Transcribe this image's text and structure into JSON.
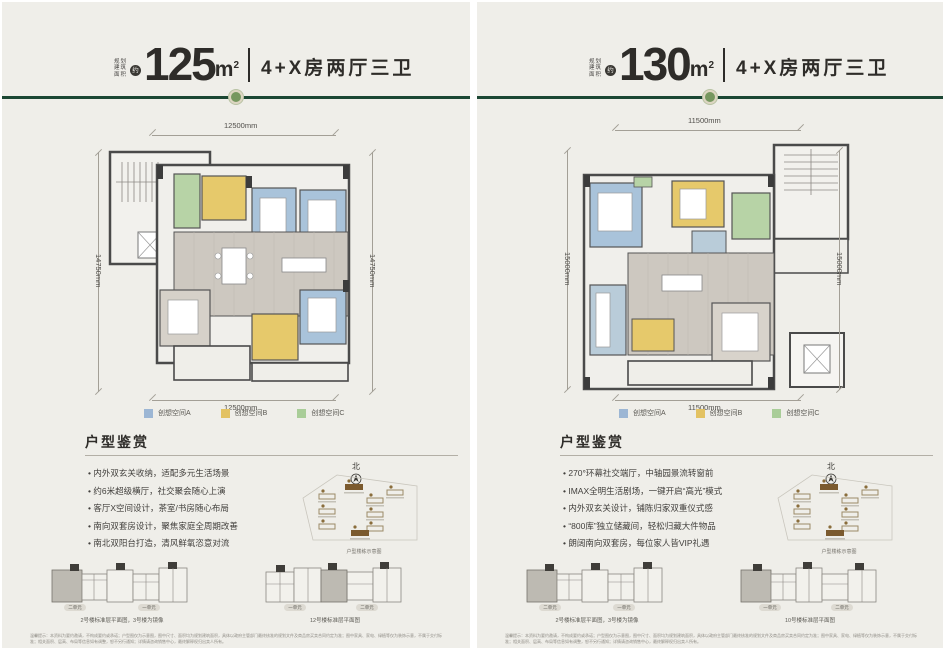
{
  "colors": {
    "divider_green": "#1b4733",
    "ornament_green": "#76975f",
    "legend_a_blue": "#9cb6d4",
    "legend_b_yellow": "#e3c262",
    "legend_c_green": "#a9cd98",
    "room_blue": "#a9c3da",
    "room_yellow": "#e6c96b",
    "room_green": "#b7d3a6",
    "floor_gray": "#cdc8c0",
    "panel_bg": "#efeee9"
  },
  "panels": [
    {
      "header": {
        "area_label_lines": [
          "规划",
          "建筑",
          "面积"
        ],
        "approx": "约",
        "area_value": "125",
        "area_unit": "m",
        "area_exp": "2",
        "type_text": "4+X房两厅三卫"
      },
      "plan_dims": {
        "top": "12500mm",
        "bottom": "12500mm",
        "left": "14750mm",
        "right": "14750mm"
      },
      "legend": [
        {
          "label": "创想空间A",
          "color": "#9cb6d4"
        },
        {
          "label": "创想空间B",
          "color": "#e3c262"
        },
        {
          "label": "创想空间C",
          "color": "#a9cd98"
        }
      ],
      "section_title": "户型鉴赏",
      "bullets": [
        "内外双玄关收纳，适配多元生活场景",
        "约6米超级横厅，社交聚会随心上演",
        "客厅X空间设计，茶室/书房随心布局",
        "南向双套房设计，聚焦家庭全周期改善",
        "南北双阳台打造，清风鲜氧恣意对流"
      ],
      "north_label": "北",
      "siteplan_caption": "户型楼栋示意图",
      "footer_diagrams": [
        {
          "caption": "2号楼标准层平面图，3号楼为镜像",
          "unit_left": "二单元",
          "unit_right": "一单元"
        },
        {
          "caption": "12号楼标准层平面图",
          "unit_left": "一单元",
          "unit_right": "二单元"
        }
      ],
      "disclaimer": "温馨提示：本资料为要约邀请，不构成要约或承诺；户型图仅为示意图，图中尺寸、面积均为规划建筑面积，具体以政府主管部门最终核准的规划文件及商品房买卖合同约定为准；图中家具、家电、绿植等仅为装饰示意，不属于交付标准；相关面积、层高、布局等信息如有调整，恕不另行通知；详情请咨询销售中心，最终解释权归出卖人所有。"
    },
    {
      "header": {
        "area_label_lines": [
          "规划",
          "建筑",
          "面积"
        ],
        "approx": "约",
        "area_value": "130",
        "area_unit": "m",
        "area_exp": "2",
        "type_text": "4+X房两厅三卫"
      },
      "plan_dims": {
        "top": "11500mm",
        "bottom": "11500mm",
        "left": "15000mm",
        "right": "15000mm"
      },
      "legend": [
        {
          "label": "创想空间A",
          "color": "#9cb6d4"
        },
        {
          "label": "创想空间B",
          "color": "#e3c262"
        },
        {
          "label": "创想空间C",
          "color": "#a9cd98"
        }
      ],
      "section_title": "户型鉴赏",
      "bullets": [
        "270°环幕社交端厅，中轴园景流转窗前",
        "IMAX全明生活剧场，一键开启“高光”模式",
        "内外双玄关设计，铺陈归家双重仪式感",
        "“800库”独立储藏间，轻松归藏大件物品",
        "朗阔南向双套房，每位家人皆VIP礼遇"
      ],
      "north_label": "北",
      "siteplan_caption": "户型楼栋示意图",
      "footer_diagrams": [
        {
          "caption": "2号楼标准层平面图，3号楼为镜像",
          "unit_left": "二单元",
          "unit_right": "一单元"
        },
        {
          "caption": "10号楼标准层平面图",
          "unit_left": "一单元",
          "unit_right": "二单元"
        }
      ],
      "disclaimer": "温馨提示：本资料为要约邀请，不构成要约或承诺；户型图仅为示意图，图中尺寸、面积均为规划建筑面积，具体以政府主管部门最终核准的规划文件及商品房买卖合同约定为准；图中家具、家电、绿植等仅为装饰示意，不属于交付标准；相关面积、层高、布局等信息如有调整，恕不另行通知；详情请咨询销售中心，最终解释权归出卖人所有。"
    }
  ]
}
